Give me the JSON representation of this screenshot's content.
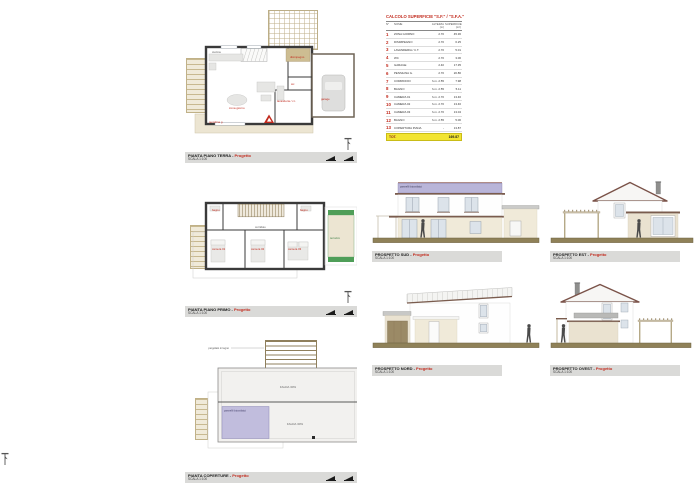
{
  "table": {
    "title": "CALCOLO SUPERFICIE \"S.F.\" / \"S.F.A.\"",
    "headers": {
      "num": "N°",
      "name": "NOME",
      "height": "ALTEZZA (m)",
      "area": "SUPERFICIE (m²)"
    },
    "rows": [
      {
        "num": "1",
        "name": "ZONA GIORNO",
        "height": "2.70",
        "area": "45.36"
      },
      {
        "num": "2",
        "name": "DISIMPEGNO",
        "height": "2.70",
        "area": "6.25"
      },
      {
        "num": "3",
        "name": "LAVANDERIA / C.T.",
        "height": "2.70",
        "area": "5.01"
      },
      {
        "num": "4",
        "name": "WC",
        "height": "2.70",
        "area": "3.06"
      },
      {
        "num": "5",
        "name": "GARAGE",
        "height": "2.40",
        "area": "17.35"
      },
      {
        "num": "6",
        "name": "PENSILINA G.",
        "height": "2.70",
        "area": "20.86"
      },
      {
        "num": "7",
        "name": "CORRIDOIO",
        "height": "h.m. 2.55",
        "area": "7.98"
      },
      {
        "num": "8",
        "name": "BAGNO",
        "height": "h.m. 2.55",
        "area": "5.11"
      },
      {
        "num": "9",
        "name": "CAMERA 01",
        "height": "h.m. 2.70",
        "area": "13.46"
      },
      {
        "num": "10",
        "name": "CAMERA 02",
        "height": "h.m. 2.70",
        "area": "13.46"
      },
      {
        "num": "11",
        "name": "CAMERA 03",
        "height": "h.m. 2.70",
        "area": "13.04"
      },
      {
        "num": "12",
        "name": "BAGNO",
        "height": "h.m. 2.55",
        "area": "5.06"
      },
      {
        "num": "13",
        "name": "COPERTURA PIANA",
        "height": "-",
        "area": "13.87"
      }
    ],
    "total_label": "TOT.",
    "total_value": "169.87"
  },
  "plans": {
    "ground": {
      "title": "PIANTA PIANO TERRA - ",
      "accent": "Progetto",
      "scale": "SCALA 1:100",
      "labels": {
        "kitchen": "cucina",
        "zona": "zona giorno",
        "hall": "disimpegno",
        "wc": "wc",
        "laundry": "lavanderia / c.t.",
        "garage": "garage",
        "canopy": "pensilina g."
      }
    },
    "first": {
      "title": "PIANTA PIANO PRIMO - ",
      "accent": "Progetto",
      "scale": "SCALA 1:100",
      "labels": {
        "bath1": "bagno",
        "bath2": "bagno",
        "corridor": "corridoio",
        "room1": "camera 01",
        "room2": "camera 02",
        "room3": "camera 03",
        "terrace": "terrazzo"
      }
    },
    "roof": {
      "title": "PIANTA COPERTURE - ",
      "accent": "Progetto",
      "scale": "SCALA 1:100",
      "labels": {
        "pergola": "pergolato in legno",
        "slope_upper": "FALDA 30%",
        "slope_lower": "FALDA 30%",
        "pv": "pannelli fotovoltaici"
      }
    }
  },
  "elevations": {
    "south": {
      "title": "PROSPETTO SUD - ",
      "accent": "Progetto",
      "scale": "SCALA 1:100",
      "pv_label": "pannelli fotovoltaici"
    },
    "east": {
      "title": "PROSPETTO EST - ",
      "accent": "Progetto",
      "scale": "SCALA 1:100"
    },
    "north": {
      "title": "PROSPETTO NORD - ",
      "accent": "Progetto",
      "scale": "SCALA 1:100"
    },
    "west": {
      "title": "PROSPETTO OVEST - ",
      "accent": "Progetto",
      "scale": "SCALA 1:100"
    }
  }
}
